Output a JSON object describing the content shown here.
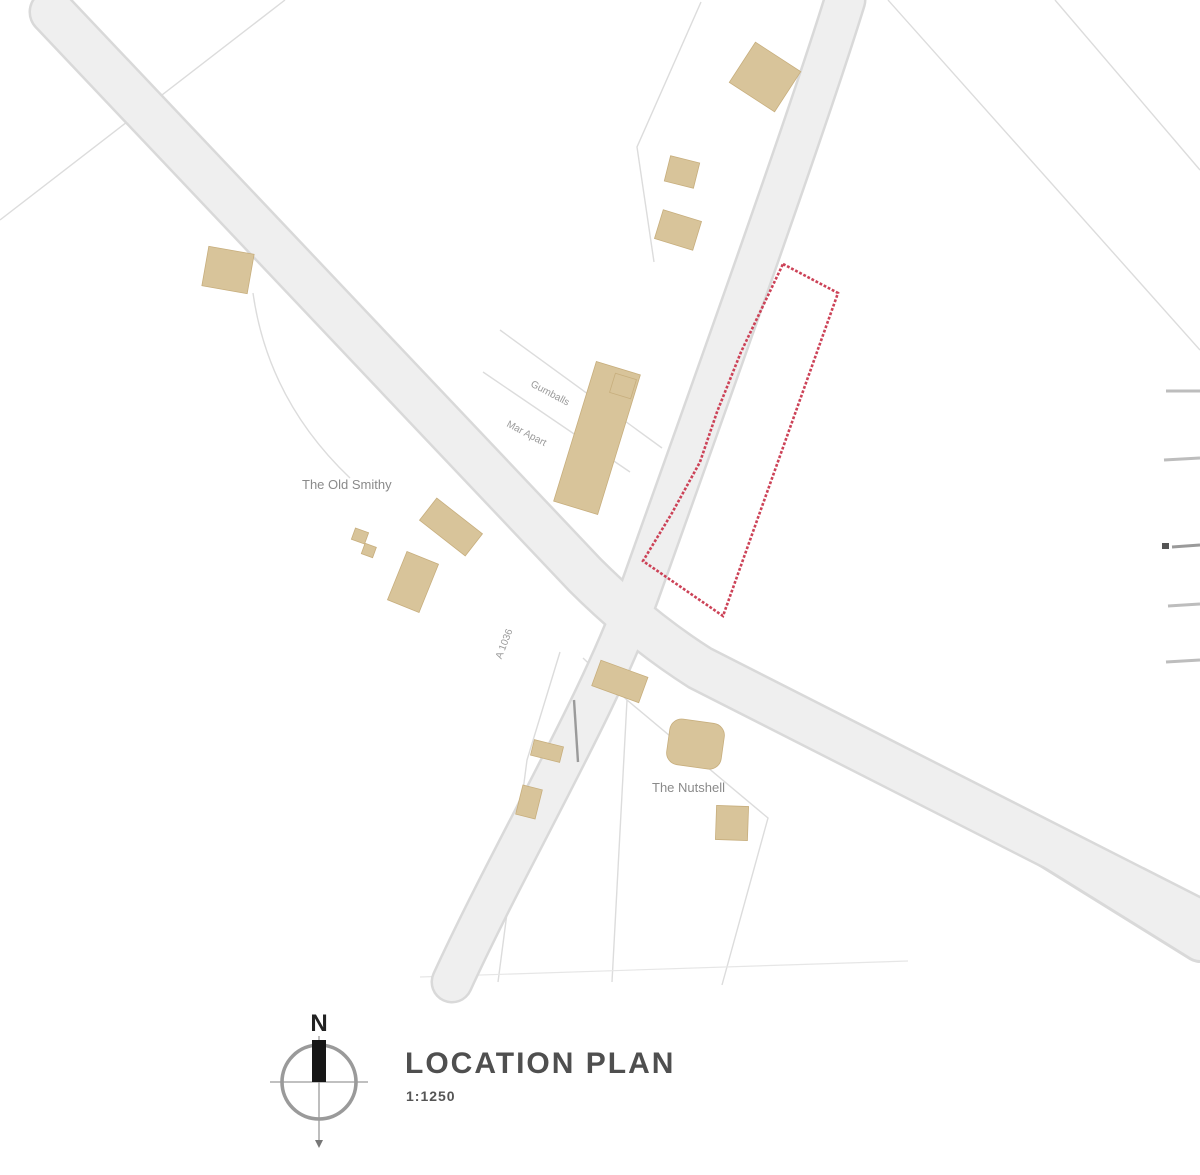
{
  "title_block": {
    "title": "LOCATION PLAN",
    "scale": "1:1250"
  },
  "compass": {
    "north_label": "N"
  },
  "map": {
    "labels": {
      "old_smithy": "The Old Smithy",
      "nutshell": "The Nutshell",
      "road_name": "A 1036",
      "plot1": "Gumballs",
      "plot2": "Mar Apart"
    }
  },
  "colors": {
    "site_boundary": "#cc4257",
    "building_fill": "#d8c49a",
    "building_edge": "#c7ae7d",
    "road_fill": "#efefef",
    "road_edge": "#d9d9d9",
    "parcel_line": "#dcdcdc",
    "label_text": "#8a8a8a",
    "title_text": "#4f4f4f"
  }
}
